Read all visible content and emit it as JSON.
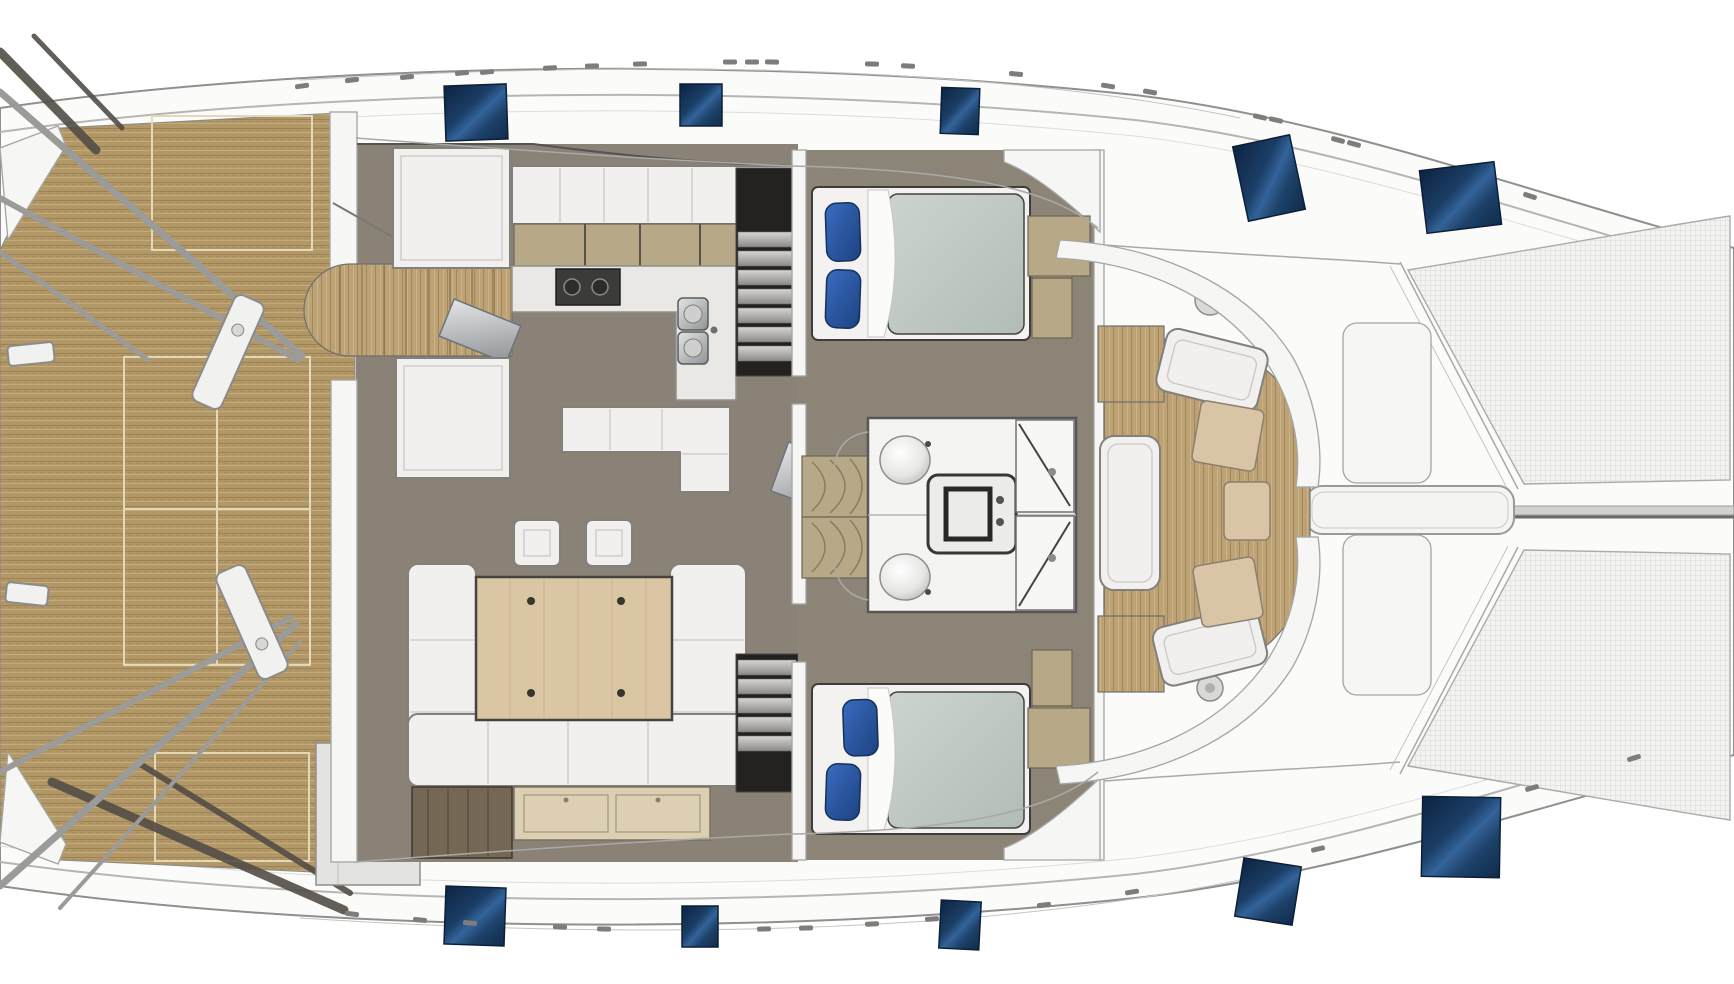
{
  "page": {
    "title": "Catamaran yacht deck and saloon floor plan",
    "type": "floor-plan",
    "orientation": "bow-right"
  },
  "colors": {
    "hull": "#fbfbfa",
    "outline": "#8f8f8d",
    "teak": "#b29767",
    "teak_grain_dark": "#9c8256",
    "teak_grain_light": "#c4ab79",
    "floor_saloon": "#8a8177",
    "floor_cabin": "#8d8478",
    "furniture": "#f1f0ee",
    "furniture_border": "#82807b",
    "counter": "#e9e8e5",
    "cabinet_tan": "#b7a887",
    "sideboard": "#ddd0b2",
    "table_wood": "#dac6a2",
    "dark_cabinet": "#746855",
    "heads_white": "#f4f4f2",
    "stair_dark": "#242220",
    "tread": "#c6c4c1",
    "metal": "#9b9b99",
    "hatch_navy": "#142c4c",
    "hatch_highlight": "#33639a",
    "hatch_stroke": "#0c1f38",
    "duvet": "#c6cfc8",
    "pillow_blue": "#2a5cab",
    "mesh": "#f3f3f2",
    "mesh_line": "#d2d2d0"
  },
  "areas": [
    {
      "id": "aft-deck",
      "label": "Aft cockpit teak deck"
    },
    {
      "id": "davits",
      "label": "Stern davit frames"
    },
    {
      "id": "saloon",
      "label": "Saloon"
    },
    {
      "id": "galley",
      "label": "Galley with stove and twin sinks"
    },
    {
      "id": "dinette",
      "label": "Dinette U-sofa with table and two stools"
    },
    {
      "id": "companionway-port",
      "label": "Port hull companionway stairs"
    },
    {
      "id": "companionway-starboard",
      "label": "Starboard hull companionway stairs"
    },
    {
      "id": "cabin-port",
      "label": "Port double berth cabin"
    },
    {
      "id": "cabin-starboard",
      "label": "Starboard double berth cabin"
    },
    {
      "id": "bathrooms",
      "label": "Twin bathrooms with basins, WC and showers"
    },
    {
      "id": "forward-cockpit",
      "label": "Forward cockpit seating"
    },
    {
      "id": "foredeck",
      "label": "Foredeck with lockers and walkway"
    },
    {
      "id": "trampolines",
      "label": "Bow trampolines"
    }
  ],
  "inventory": {
    "berths": 2,
    "pillows_per_berth": 2,
    "bathroom_basins": 2,
    "showers": 2,
    "wardrobes": 4,
    "stools": 2,
    "deck_hatches": 10
  },
  "hatches": [
    {
      "x": 445,
      "y": 85,
      "w": 62,
      "h": 55,
      "r": -2
    },
    {
      "x": 680,
      "y": 84,
      "w": 42,
      "h": 42,
      "r": 0
    },
    {
      "x": 941,
      "y": 88,
      "w": 38,
      "h": 46,
      "r": 2
    },
    {
      "x": 1240,
      "y": 140,
      "w": 58,
      "h": 76,
      "r": -12
    },
    {
      "x": 1423,
      "y": 166,
      "w": 75,
      "h": 63,
      "r": -7
    },
    {
      "x": 445,
      "y": 887,
      "w": 60,
      "h": 58,
      "r": 2
    },
    {
      "x": 682,
      "y": 906,
      "w": 36,
      "h": 41,
      "r": 0
    },
    {
      "x": 940,
      "y": 901,
      "w": 40,
      "h": 48,
      "r": 3
    },
    {
      "x": 1239,
      "y": 862,
      "w": 58,
      "h": 59,
      "r": 9
    },
    {
      "x": 1422,
      "y": 797,
      "w": 78,
      "h": 80,
      "r": 1
    }
  ],
  "cleats": [
    {
      "x": 302,
      "y": 86,
      "a": -8
    },
    {
      "x": 352,
      "y": 80,
      "a": -7
    },
    {
      "x": 407,
      "y": 77,
      "a": -6
    },
    {
      "x": 462,
      "y": 73,
      "a": -5
    },
    {
      "x": 487,
      "y": 72,
      "a": -5
    },
    {
      "x": 550,
      "y": 68,
      "a": -3
    },
    {
      "x": 592,
      "y": 66,
      "a": -2
    },
    {
      "x": 640,
      "y": 64,
      "a": -1
    },
    {
      "x": 730,
      "y": 62,
      "a": 0
    },
    {
      "x": 752,
      "y": 62,
      "a": 0
    },
    {
      "x": 772,
      "y": 62,
      "a": 1
    },
    {
      "x": 872,
      "y": 64,
      "a": 2
    },
    {
      "x": 908,
      "y": 66,
      "a": 3
    },
    {
      "x": 1016,
      "y": 74,
      "a": 6
    },
    {
      "x": 1108,
      "y": 86,
      "a": 9
    },
    {
      "x": 1150,
      "y": 92,
      "a": 10
    },
    {
      "x": 1260,
      "y": 117,
      "a": 13
    },
    {
      "x": 1276,
      "y": 120,
      "a": 13
    },
    {
      "x": 1338,
      "y": 140,
      "a": 15
    },
    {
      "x": 1354,
      "y": 144,
      "a": 15
    },
    {
      "x": 1530,
      "y": 196,
      "a": 18
    },
    {
      "x": 352,
      "y": 914,
      "a": 7
    },
    {
      "x": 420,
      "y": 920,
      "a": 6
    },
    {
      "x": 470,
      "y": 923,
      "a": 5
    },
    {
      "x": 560,
      "y": 927,
      "a": 3
    },
    {
      "x": 604,
      "y": 929,
      "a": 2
    },
    {
      "x": 764,
      "y": 929,
      "a": -1
    },
    {
      "x": 806,
      "y": 928,
      "a": -2
    },
    {
      "x": 872,
      "y": 924,
      "a": -3
    },
    {
      "x": 932,
      "y": 919,
      "a": -4
    },
    {
      "x": 1044,
      "y": 905,
      "a": -7
    },
    {
      "x": 1132,
      "y": 892,
      "a": -9
    },
    {
      "x": 1318,
      "y": 849,
      "a": -13
    },
    {
      "x": 1532,
      "y": 788,
      "a": -16
    },
    {
      "x": 1634,
      "y": 758,
      "a": -17
    }
  ]
}
